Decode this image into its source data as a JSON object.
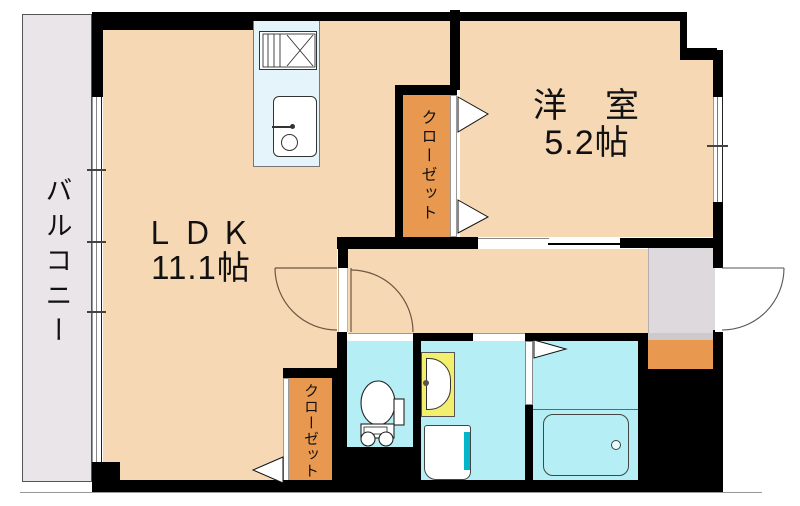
{
  "plan_title": "apartment-floor-plan",
  "rooms": {
    "balcony": {
      "label": "バルコニー"
    },
    "ldk": {
      "label": "ＬＤＫ",
      "size": "11.1帖"
    },
    "western_room": {
      "label": "洋　室",
      "size": "5.2帖"
    },
    "closet_upper": {
      "label": "クローゼット"
    },
    "closet_lower": {
      "label": "クローゼット"
    }
  },
  "fixtures": {
    "kitchen": [
      "stove",
      "sink"
    ],
    "washroom": [
      "washbasin",
      "washing-machine-pan"
    ],
    "toilet_room": [
      "toilet"
    ],
    "bathroom": [
      "bathtub"
    ]
  },
  "colors": {
    "room_floor": "#f7d8b4",
    "closet": "#e8994f",
    "wet_area": "#b5eff5",
    "kitchen_unit": "#e4f4fa",
    "vanity": "#f2ee6e",
    "washer_accent": "#00b6c8",
    "balcony": "#e9e5e9",
    "entry_floor": "#ded9dc",
    "wall": "#000000"
  }
}
